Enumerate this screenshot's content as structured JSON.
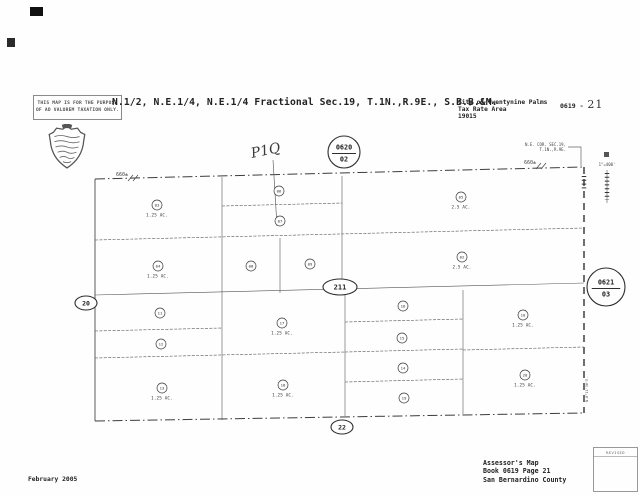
{
  "page": {
    "disclaimer_line1": "THIS MAP IS FOR THE PURPOSE",
    "disclaimer_line2": "OF AD VALOREM TAXATION ONLY.",
    "title": "N.1/2, N.E.1/4, N.E.1/4 Fractional Sec.19, T.1N.,R.9E., S.B.B.&M.",
    "header_right": {
      "city": "City of Twentynine Palms",
      "tra_label": "Tax Rate Area",
      "tra_value": "19015",
      "book_prefix": "0619 -",
      "page_handwritten": "21"
    },
    "footer": {
      "date": "February 2005",
      "assessor_line1": "Assessor's Map",
      "assessor_line2": "Book 0619 Page 21",
      "assessor_line3": "San Bernardino County",
      "revised_label": "REVISED"
    }
  },
  "map": {
    "annotations": {
      "handwritten": "P1Q",
      "corner_note_line1": "N.E. COR. SEC.19,",
      "corner_note_line2": "T.1N.,R.9E.",
      "scale": "1\"=400'",
      "bearing_east": "N.0°11'30\"E.",
      "dim_top_left": "660±",
      "dim_top_right": "660±"
    },
    "page_refs": [
      {
        "label": "0620",
        "sub": "02",
        "shape": "circle",
        "x": 344,
        "y": 152,
        "r": 16
      },
      {
        "label": "0621",
        "sub": "03",
        "shape": "circle",
        "x": 606,
        "y": 287,
        "r": 19
      },
      {
        "label": "211",
        "shape": "ellipse",
        "x": 340,
        "y": 287,
        "rx": 17,
        "ry": 8,
        "fs": 7
      },
      {
        "label": "20",
        "shape": "ellipse",
        "x": 86,
        "y": 303,
        "rx": 11,
        "ry": 7,
        "fs": 6.5
      },
      {
        "label": "22",
        "shape": "ellipse",
        "x": 342,
        "y": 427,
        "rx": 11,
        "ry": 7,
        "fs": 6.5
      }
    ],
    "parcels": [
      {
        "num": "03",
        "ac": "1.25 AC.",
        "x": 157,
        "y": 205
      },
      {
        "num": "06",
        "x": 279,
        "y": 191
      },
      {
        "num": "07",
        "x": 280,
        "y": 221
      },
      {
        "num": "05",
        "ac": "2.5 AC.",
        "x": 461,
        "y": 197
      },
      {
        "num": "04",
        "ac": "1.25 AC.",
        "x": 158,
        "y": 266
      },
      {
        "num": "08",
        "x": 251,
        "y": 266
      },
      {
        "num": "09",
        "x": 310,
        "y": 264
      },
      {
        "num": "02",
        "ac": "2.5 AC.",
        "x": 462,
        "y": 257
      },
      {
        "num": "11",
        "x": 160,
        "y": 313
      },
      {
        "num": "12",
        "x": 161,
        "y": 344
      },
      {
        "num": "13",
        "ac": "1.25 AC.",
        "x": 162,
        "y": 388
      },
      {
        "num": "17",
        "ac": "1.25 AC.",
        "x": 282,
        "y": 323
      },
      {
        "num": "18",
        "ac": "1.25 AC.",
        "x": 283,
        "y": 385
      },
      {
        "num": "16",
        "x": 403,
        "y": 306
      },
      {
        "num": "15",
        "x": 402,
        "y": 338
      },
      {
        "num": "14",
        "x": 403,
        "y": 368
      },
      {
        "num": "19",
        "x": 404,
        "y": 398
      },
      {
        "num": "10",
        "ac": "1.25 AC.",
        "x": 523,
        "y": 315
      },
      {
        "num": "20",
        "ac": "1.25 AC.",
        "x": 525,
        "y": 375
      }
    ]
  },
  "colors": {
    "ink": "#3a3a3a",
    "paper": "#fefefe",
    "pencil": "#666666"
  }
}
